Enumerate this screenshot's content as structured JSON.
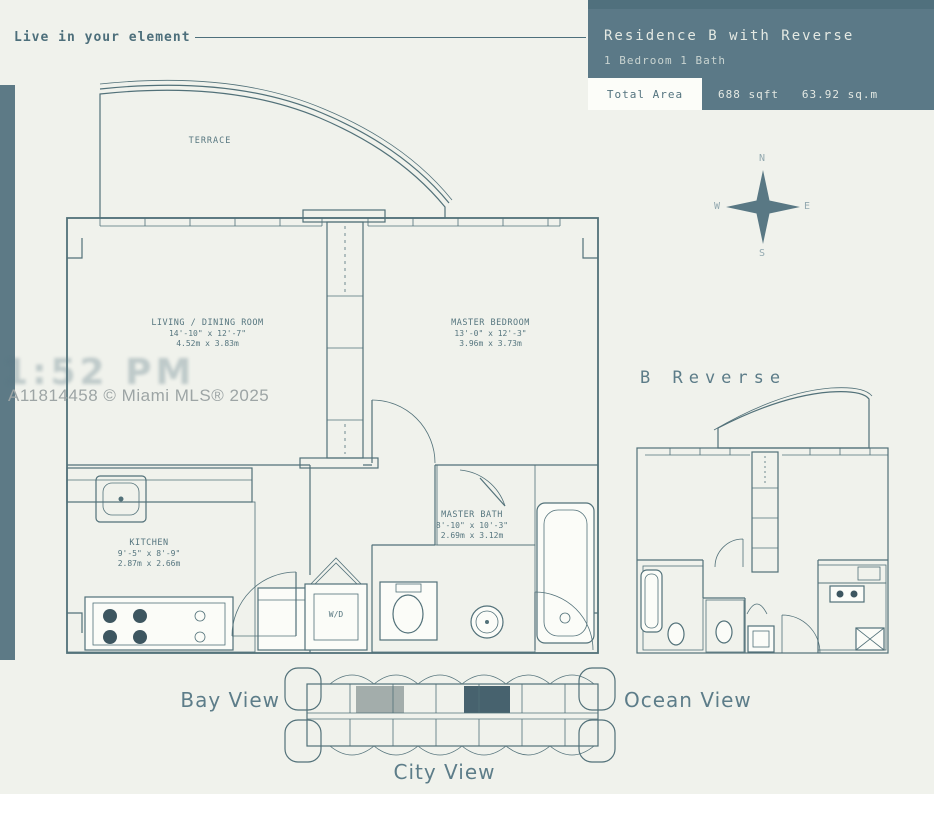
{
  "page": {
    "bg": "#f0f2ec",
    "accent_bar": "#5d7a86"
  },
  "tagline": {
    "text": "Live in your element"
  },
  "header": {
    "bg": "#5b7987",
    "title": "Residence B with Reverse",
    "subtitle": "1 Bedroom 1 Bath",
    "total_area_label": "Total Area",
    "total_area_value": "688 sqft   63.92 sq.m"
  },
  "compass": {
    "north": "N",
    "south": "S",
    "east": "E",
    "west": "W"
  },
  "watermark": {
    "mls": "A11814458 © Miami MLS® 2025",
    "ghost": "11:52 PM"
  },
  "main_plan": {
    "terrace": "TERRACE",
    "living": {
      "name": "LIVING / DINING ROOM",
      "imperial": "14'-10\" x 12'-7\"",
      "metric": "4.52m x 3.83m"
    },
    "bedroom": {
      "name": "MASTER BEDROOM",
      "imperial": "13'-0\" x 12'-3\"",
      "metric": "3.96m x 3.73m"
    },
    "kitchen": {
      "name": "KITCHEN",
      "imperial": "9'-5\" x 8'-9\"",
      "metric": "2.87m x 2.66m"
    },
    "bath": {
      "name": "MASTER BATH",
      "imperial": "8'-10\" x 10'-3\"",
      "metric": "2.69m x 3.12m"
    },
    "wd": "W/D"
  },
  "reverse_plan": {
    "label": "B Reverse"
  },
  "keyplan": {
    "bay": "Bay View",
    "ocean": "Ocean View",
    "city": "City View",
    "highlight_light": "#a3adab",
    "highlight_dark": "#47626e"
  }
}
